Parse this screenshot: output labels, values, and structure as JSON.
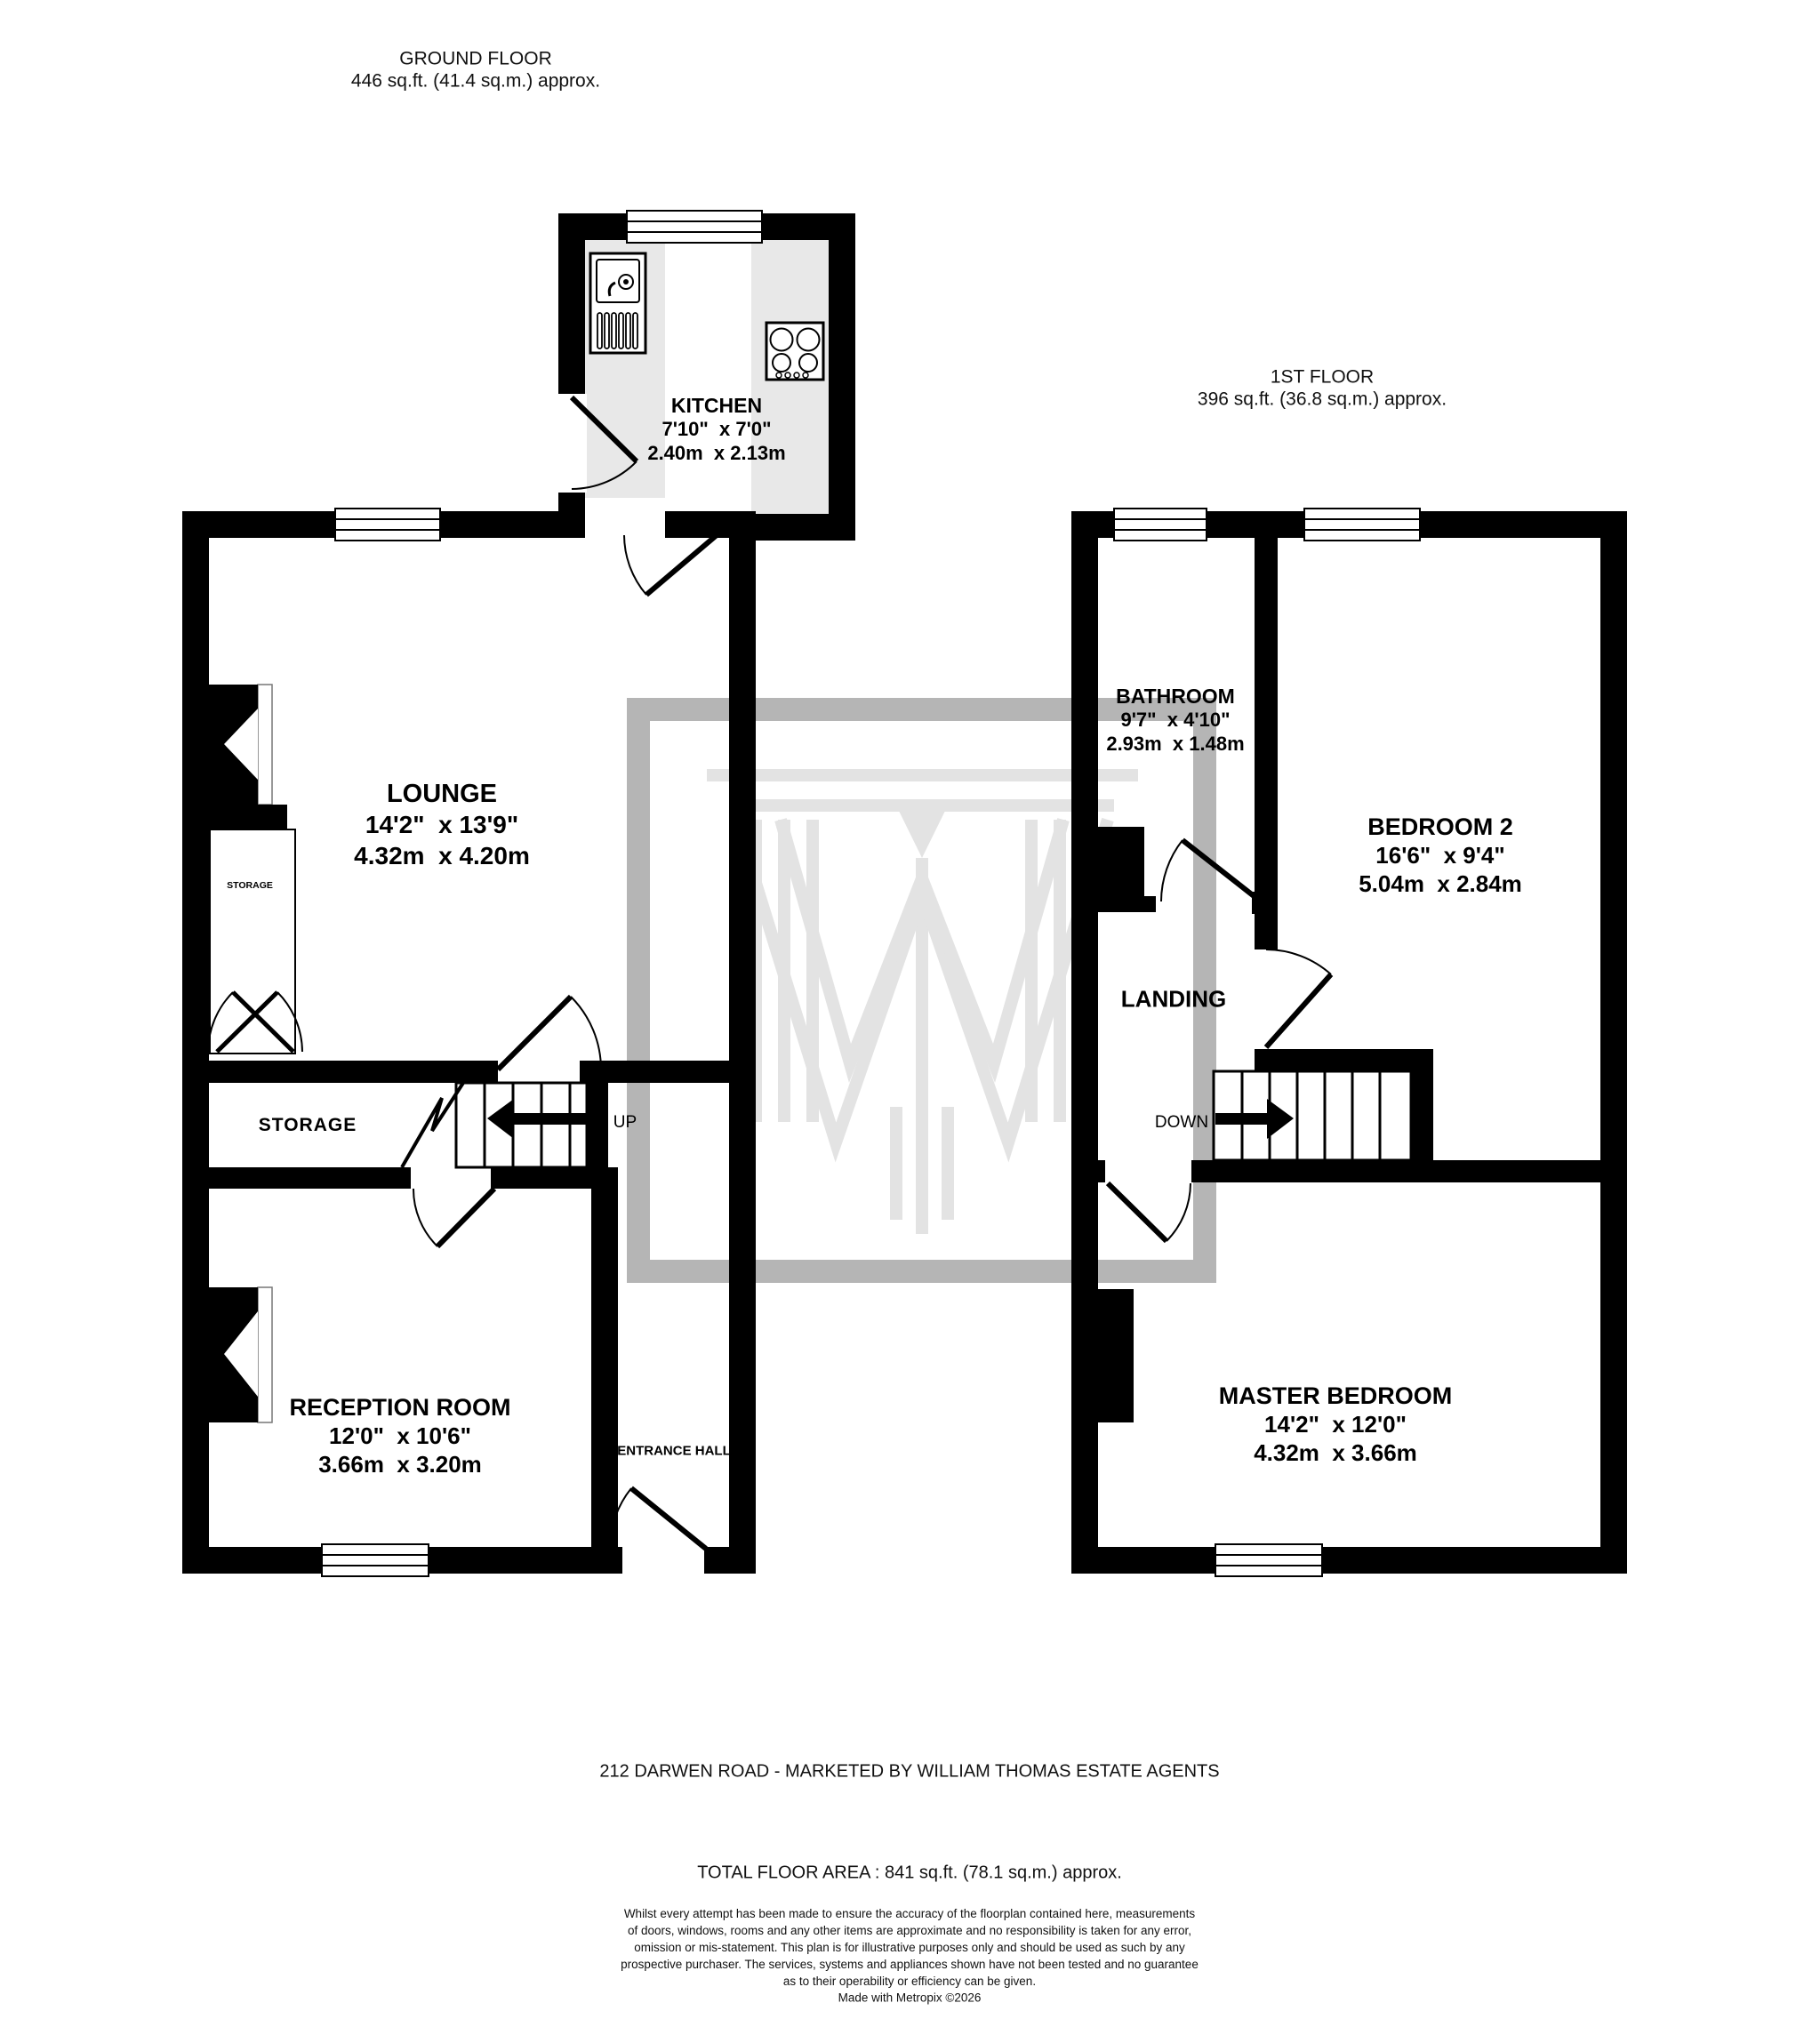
{
  "ground_floor": {
    "title": "GROUND FLOOR",
    "area": "446 sq.ft. (41.4 sq.m.) approx.",
    "rooms": {
      "kitchen": {
        "name": "KITCHEN",
        "imperial": "7'10\"  x 7'0\"",
        "metric": "2.40m  x 2.13m"
      },
      "lounge": {
        "name": "LOUNGE",
        "imperial": "14'2\"  x 13'9\"",
        "metric": "4.32m  x 4.20m"
      },
      "reception": {
        "name": "RECEPTION ROOM",
        "imperial": "12'0\"  x 10'6\"",
        "metric": "3.66m  x 3.20m"
      }
    },
    "labels": {
      "storage_band": "STORAGE",
      "storage_closet": "STORAGE",
      "entrance_hall": "ENTRANCE HALL",
      "up": "UP"
    }
  },
  "first_floor": {
    "title": "1ST FLOOR",
    "area": "396 sq.ft. (36.8 sq.m.) approx.",
    "rooms": {
      "bathroom": {
        "name": "BATHROOM",
        "imperial": "9'7\"  x 4'10\"",
        "metric": "2.93m  x 1.48m"
      },
      "bedroom2": {
        "name": "BEDROOM 2",
        "imperial": "16'6\"  x 9'4\"",
        "metric": "5.04m  x 2.84m"
      },
      "master": {
        "name": "MASTER BEDROOM",
        "imperial": "14'2\"  x 12'0\"",
        "metric": "4.32m  x 3.66m"
      }
    },
    "labels": {
      "landing": "LANDING",
      "down": "DOWN"
    }
  },
  "footer": {
    "address": "212 DARWEN ROAD - MARKETED BY WILLIAM THOMAS ESTATE AGENTS",
    "total_area": "TOTAL FLOOR AREA : 841 sq.ft. (78.1 sq.m.) approx.",
    "disclaimer": "Whilst every attempt has been made to ensure the accuracy of the floorplan contained here, measurements\nof doors, windows, rooms and any other items are approximate and no responsibility is taken for any error,\nomission or mis-statement. This plan is for illustrative purposes only and should be used as such by any\nprospective purchaser. The services, systems and appliances shown have not been tested and no guarantee\nas to their operability or efficiency can be given.",
    "credit": "Made with Metropix ©2026"
  },
  "colors": {
    "wall": "#000000",
    "counter": "#e8e8e8",
    "watermark_border": "#b5b5b5",
    "watermark_logo": "#e3e3e3"
  }
}
